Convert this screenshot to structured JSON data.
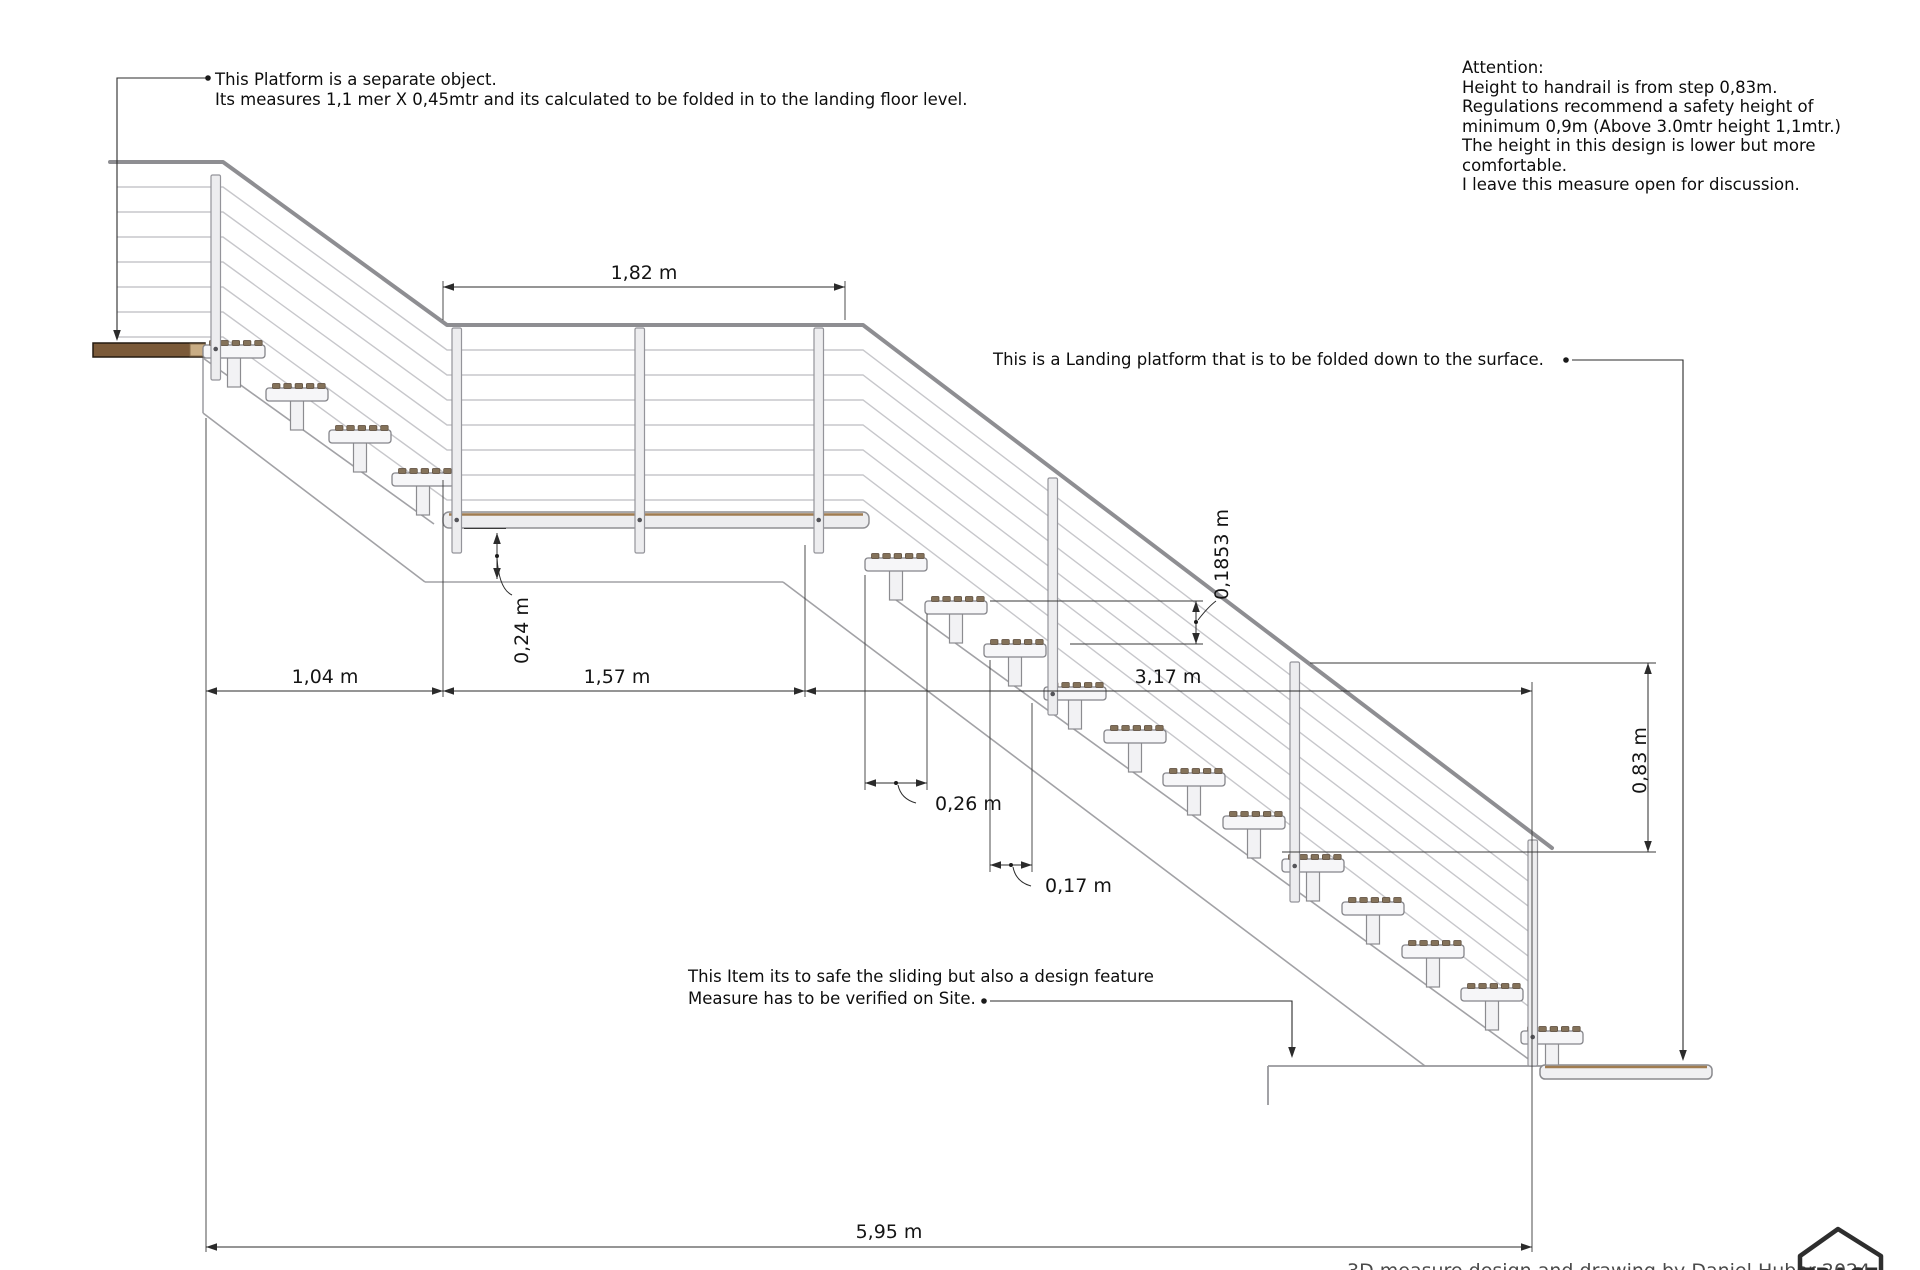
{
  "annotations": {
    "platform_note": {
      "line1": "This Platform is a separate object.",
      "line2": "Its measures 1,1 mer X 0,45mtr and its calculated to be folded in to the landing floor level."
    },
    "attention": [
      "Attention:",
      "Height to handrail is from step 0,83m.",
      "Regulations recommend a safety height of",
      "minimum 0,9m (Above 3.0mtr height 1,1mtr.)",
      "The height in this design is lower but more",
      "comfortable.",
      "I leave this measure open for discussion."
    ],
    "landing_note": "This is a Landing platform that is to be folded down to the surface.",
    "slide_note": {
      "line1": "This Item its to safe the sliding but also a design feature",
      "line2": "Measure has to be verified on Site."
    },
    "credit": "3D measure design and drawing by Daniel Huber 2024"
  },
  "dimensions": {
    "landing_width": "1,82 m",
    "landing_depth": "0,24 m",
    "upper_run": "1,04 m",
    "middle_run": "1,57 m",
    "lower_run": "3,17 m",
    "tread_depth": "0,26 m",
    "tread_offset": "0,17 m",
    "step_rise": "0,1853 m",
    "handrail_height": "0,83 m",
    "total_run": "5,95 m"
  },
  "logo": {
    "text": "TRACE"
  },
  "colors": {
    "wood_dark": "#7b5a39",
    "wood_accent": "#a07c50",
    "steel_light": "#ededef",
    "line_gray": "#a2a2a6",
    "dim_black": "#2b2b2b"
  }
}
